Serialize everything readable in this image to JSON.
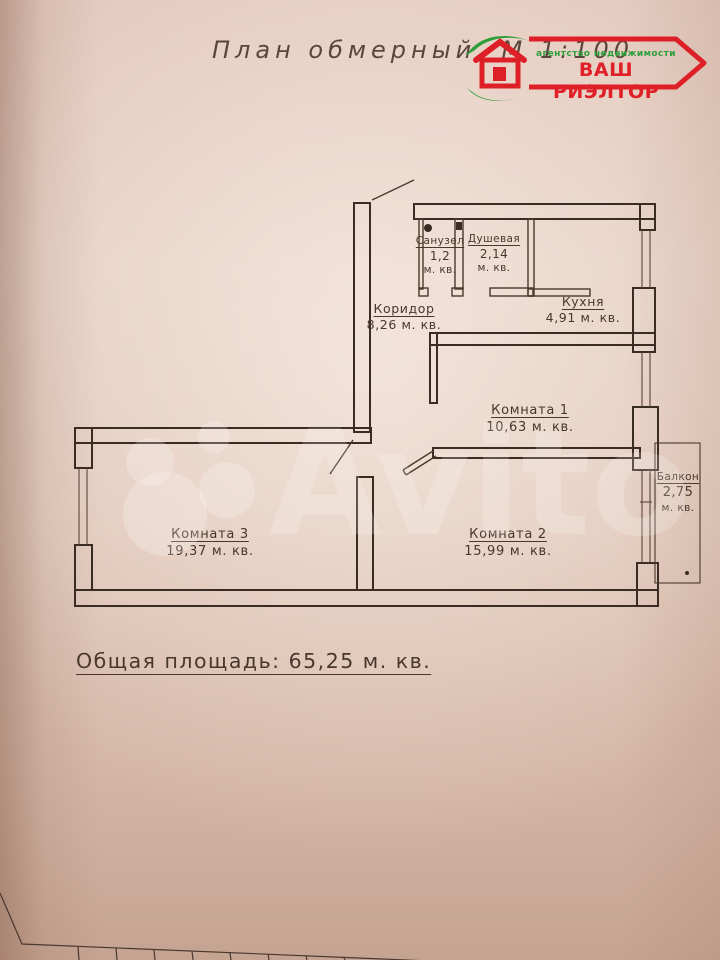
{
  "page": {
    "title": "План обмерный.  М 1:100",
    "total_area_label": "Общая  площадь: 65,25 м. кв."
  },
  "logo": {
    "tagline": "агентство недвижимости",
    "name": "ВАШ РИЭЛТОР",
    "colors": {
      "red": "#e02028",
      "green": "#2f9e3c"
    }
  },
  "rooms": {
    "sanuzel": {
      "name": "Санузел",
      "area": "1,2",
      "unit": "м. кв."
    },
    "dushevaya": {
      "name": "Душевая",
      "area": "2,14",
      "unit": "м. кв."
    },
    "koridor": {
      "name": "Коридор",
      "area": "8,26 м. кв."
    },
    "kuhnya": {
      "name": "Кухня",
      "area": "4,91 м. кв."
    },
    "komnata1": {
      "name": "Комната 1",
      "area": "10,63 м. кв."
    },
    "komnata2": {
      "name": "Комната 2",
      "area": "15,99 м. кв."
    },
    "komnata3": {
      "name": "Комната 3",
      "area": "19,37 м. кв."
    },
    "balkon": {
      "name": "Балкон",
      "area": "2,75",
      "unit": "м. кв."
    }
  },
  "watermark": {
    "text": "Avito"
  }
}
